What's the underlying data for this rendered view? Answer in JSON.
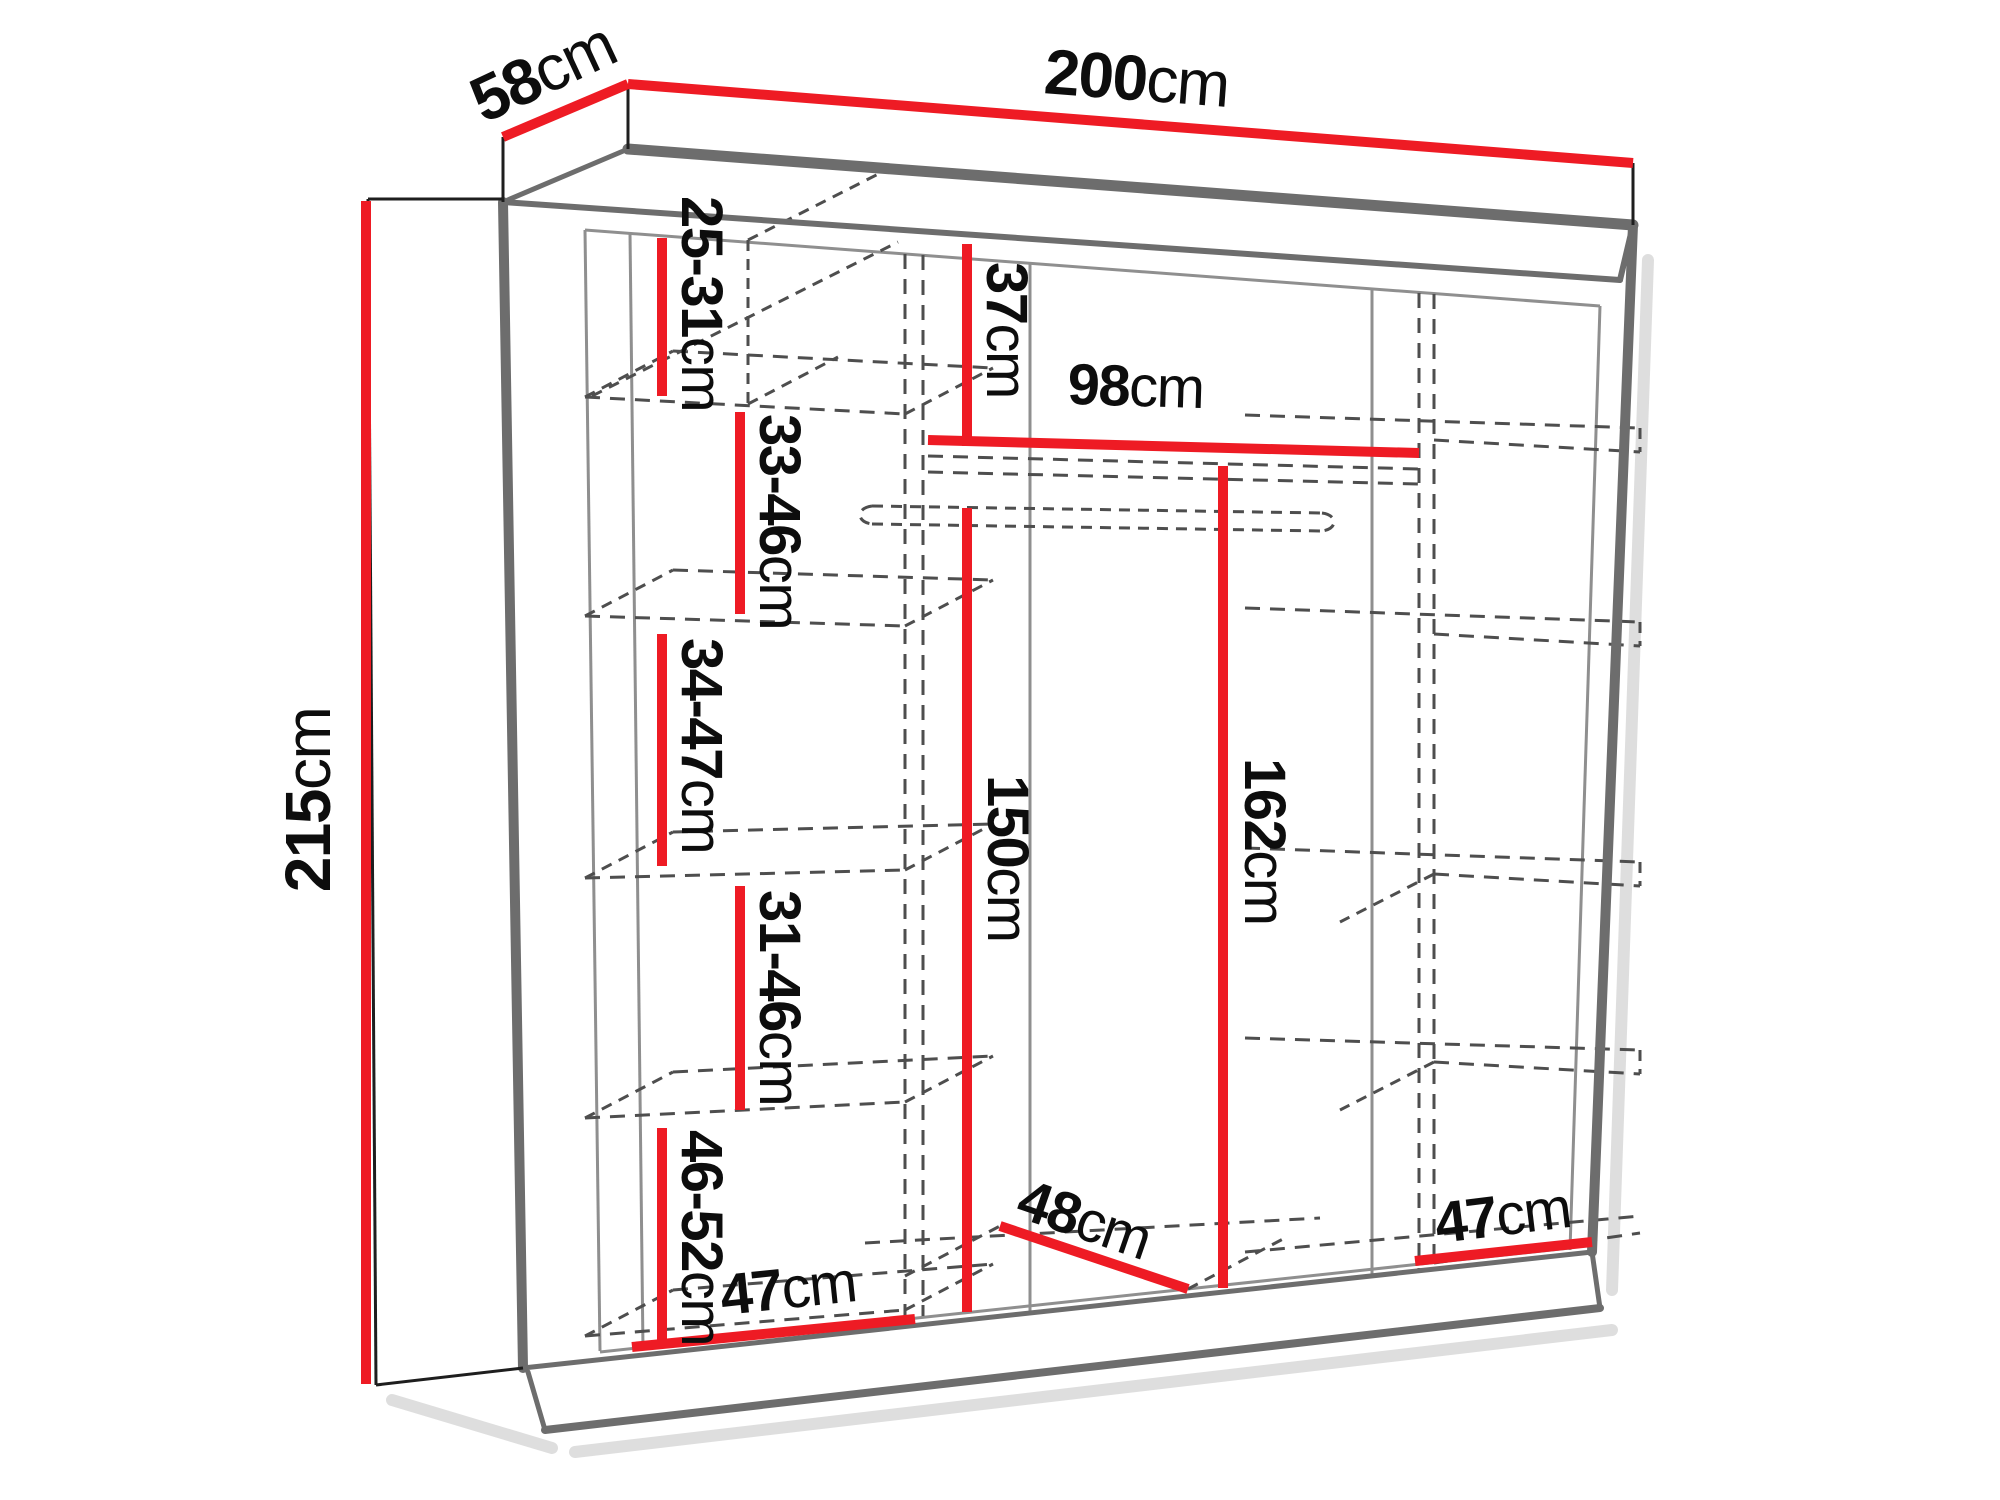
{
  "diagram": {
    "name": "Sliding wardrobe dimension diagram",
    "unit": "cm"
  },
  "colors": {
    "dimension_red": "#ee1b24",
    "outline_gray": "#6d6d6d",
    "interior_gray": "#8f8f8f",
    "hidden_gray": "#4e4e4e",
    "extension_black": "#1e1e1e",
    "shadow_gray": "#d4d4d4",
    "text_black": "#0d0d0d",
    "background": "#ffffff"
  },
  "dimensions": {
    "width": {
      "value": "200",
      "unit": "cm"
    },
    "depth": {
      "value": "58",
      "unit": "cm"
    },
    "height": {
      "value": "215",
      "unit": "cm"
    },
    "left_gap_top": {
      "value": "25-31",
      "unit": "cm"
    },
    "left_gap_2": {
      "value": "33-46",
      "unit": "cm"
    },
    "left_gap_3": {
      "value": "34-47",
      "unit": "cm"
    },
    "left_gap_4": {
      "value": "31-46",
      "unit": "cm"
    },
    "left_gap_5": {
      "value": "46-52",
      "unit": "cm"
    },
    "left_width": {
      "value": "47",
      "unit": "cm"
    },
    "middle_top_gap": {
      "value": "37",
      "unit": "cm"
    },
    "middle_width": {
      "value": "98",
      "unit": "cm"
    },
    "hanging_height_left": {
      "value": "150",
      "unit": "cm"
    },
    "hanging_height_right": {
      "value": "162",
      "unit": "cm"
    },
    "middle_depth": {
      "value": "48",
      "unit": "cm"
    },
    "right_width": {
      "value": "47",
      "unit": "cm"
    }
  }
}
